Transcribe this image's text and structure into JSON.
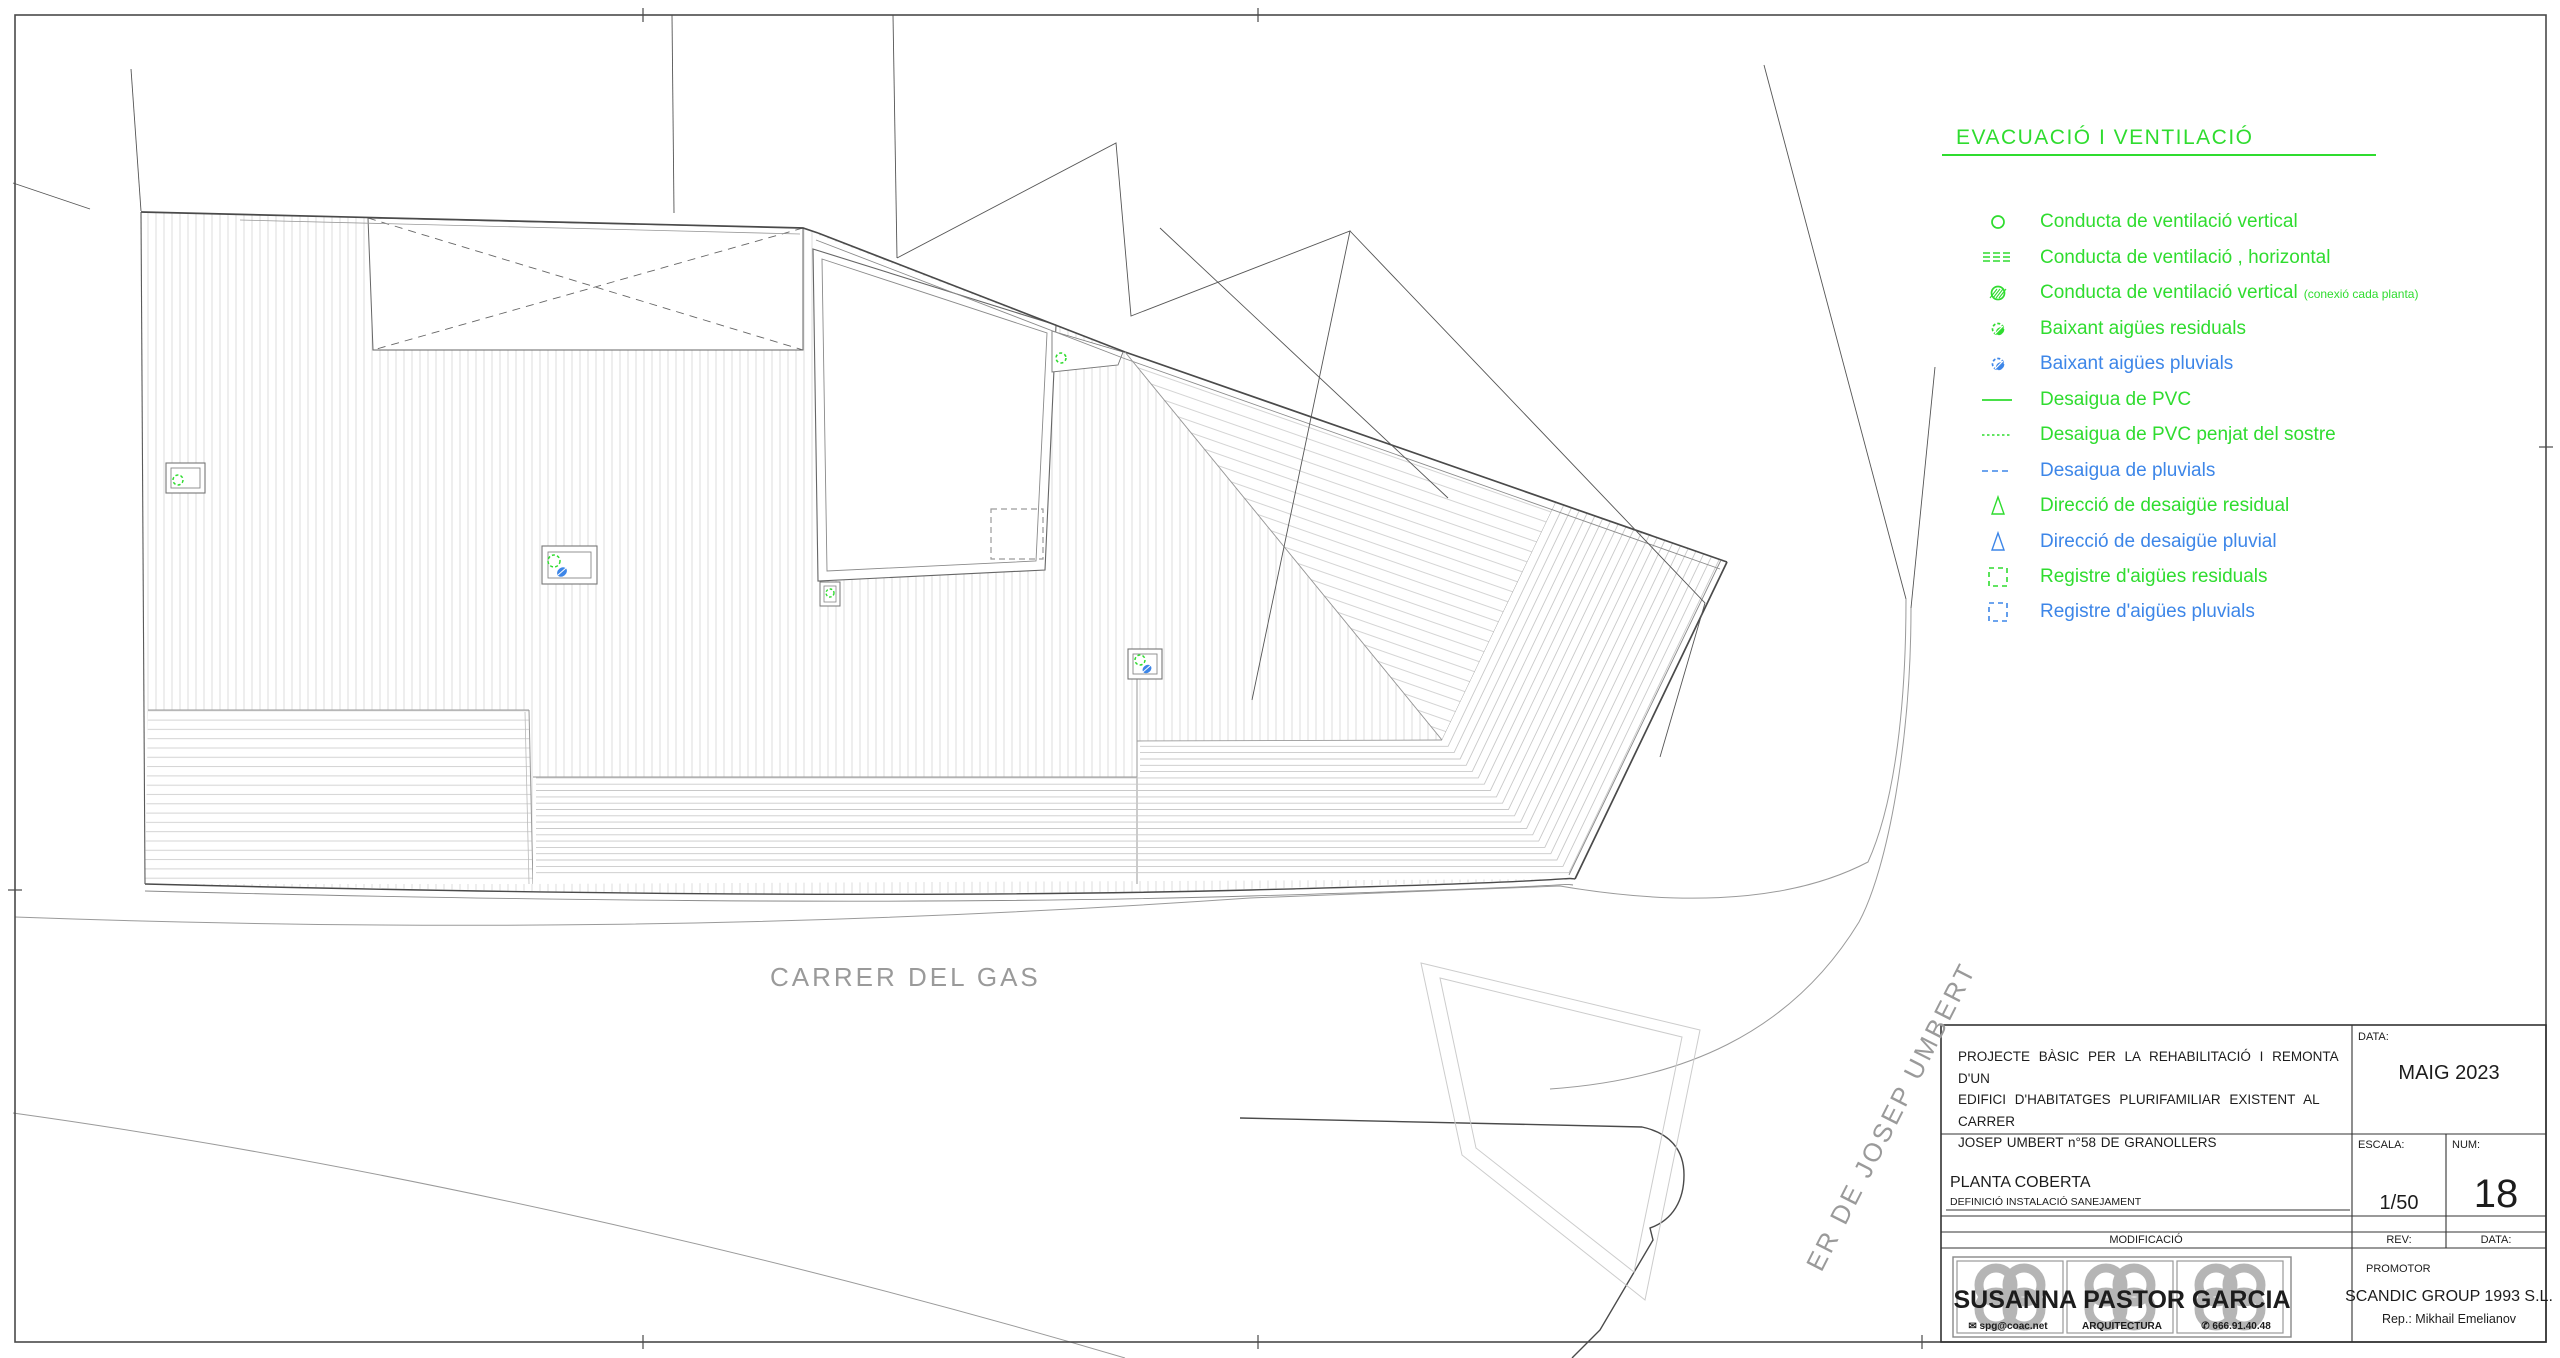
{
  "colors": {
    "green": "#2fdc2f",
    "blue": "#3d86e8",
    "gray_text": "#9a9a9a",
    "line_dark": "#4a4a4a",
    "line_mid": "#8a8a8a",
    "hatch": "#d9d9d9"
  },
  "legend": {
    "title": "EVACUACIÓ I  VENTILACIÓ",
    "items": [
      {
        "icon": "circle-outline",
        "color": "green",
        "label": "Conducta de ventilació vertical",
        "suffix": ""
      },
      {
        "icon": "triple-dashed-line",
        "color": "green",
        "label": "Conducta de ventilació , horizontal",
        "suffix": ""
      },
      {
        "icon": "circle-hatched",
        "color": "green",
        "label": "Conducta de ventilació vertical",
        "suffix": "(conexió cada planta)"
      },
      {
        "icon": "drain-drop",
        "color": "green",
        "label": "Baixant aigües residuals",
        "suffix": ""
      },
      {
        "icon": "drain-drop",
        "color": "blue",
        "label": "Baixant aigües pluvials",
        "suffix": ""
      },
      {
        "icon": "solid-line",
        "color": "green",
        "label": "Desaigua de PVC",
        "suffix": ""
      },
      {
        "icon": "fine-dashed-line",
        "color": "green",
        "label": "Desaigua de PVC penjat del sostre",
        "suffix": ""
      },
      {
        "icon": "dashed-line",
        "color": "blue",
        "label": "Desaigua de pluvials",
        "suffix": ""
      },
      {
        "icon": "triangle-outline",
        "color": "green",
        "label": "Direcció de desaigüe residual",
        "suffix": ""
      },
      {
        "icon": "triangle-outline",
        "color": "blue",
        "label": "Direcció de desaigüe pluvial",
        "suffix": ""
      },
      {
        "icon": "dashed-square",
        "color": "green",
        "label": "Registre d'aigües residuals",
        "suffix": ""
      },
      {
        "icon": "dashed-square",
        "color": "blue",
        "label": "Registre d'aigües pluvials",
        "suffix": ""
      }
    ]
  },
  "streets": {
    "gas": "CARRER DEL GAS",
    "umbert": "ER DE JOSEP UMBERT"
  },
  "title_block": {
    "description_line1": "PROJECTE  BÀSIC  PER  LA  REHABILITACIÓ  I  REMONTA  D'UN",
    "description_line2": "EDIFICI  D'HABITATGES  PLURIFAMILIAR  EXISTENT  AL  CARRER",
    "description_line3": "JOSEP UMBERT n°58 DE GRANOLLERS",
    "data_label": "DATA:",
    "data_value": "MAIG 2023",
    "plan_title": "PLANTA COBERTA",
    "plan_subtitle": "DEFINICIÓ INSTALACIÓ SANEJAMENT",
    "escala_label": "ESCALA:",
    "escala_value": "1/50",
    "num_label": "NUM:",
    "num_value": "18",
    "modificacio_label": "MODIFICACIÓ",
    "rev_label": "REV:",
    "data2_label": "DATA:",
    "promotor_label": "PROMOTOR",
    "promotor_name": "SCANDIC GROUP 1993 S.L.",
    "promotor_rep": "Rep.: Mikhail Emelianov",
    "architect_name": "SUSANNA PASTOR GARCIA",
    "architect_email": "✉ spg@coac.net",
    "architect_brand": "ARQUITECTURA",
    "architect_phone": "✆ 666.91.40.48"
  }
}
